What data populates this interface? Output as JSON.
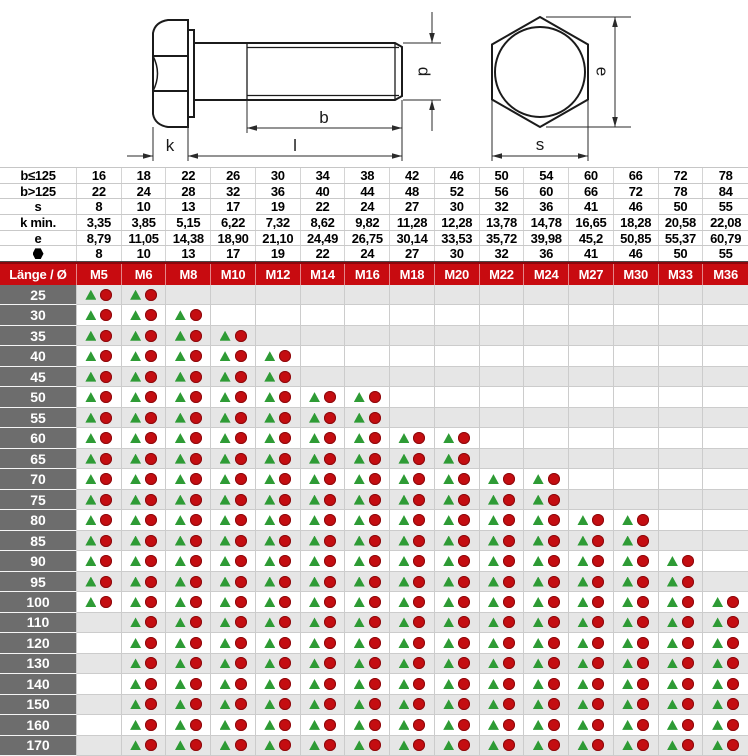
{
  "drawing": {
    "labels": {
      "k": "k",
      "l": "l",
      "b": "b",
      "d": "d",
      "e": "e",
      "s": "s"
    }
  },
  "spec_table": {
    "rows": [
      {
        "label": "b≤125",
        "values": [
          "16",
          "18",
          "22",
          "26",
          "30",
          "34",
          "38",
          "42",
          "46",
          "50",
          "54",
          "60",
          "66",
          "72",
          "78"
        ]
      },
      {
        "label": "b>125",
        "values": [
          "22",
          "24",
          "28",
          "32",
          "36",
          "40",
          "44",
          "48",
          "52",
          "56",
          "60",
          "66",
          "72",
          "78",
          "84"
        ]
      },
      {
        "label": "s",
        "values": [
          "8",
          "10",
          "13",
          "17",
          "19",
          "22",
          "24",
          "27",
          "30",
          "32",
          "36",
          "41",
          "46",
          "50",
          "55"
        ]
      },
      {
        "label": "k min.",
        "values": [
          "3,35",
          "3,85",
          "5,15",
          "6,22",
          "7,32",
          "8,62",
          "9,82",
          "11,28",
          "12,28",
          "13,78",
          "14,78",
          "16,65",
          "18,28",
          "20,58",
          "22,08"
        ]
      },
      {
        "label": "e",
        "values": [
          "8,79",
          "11,05",
          "14,38",
          "18,90",
          "21,10",
          "24,49",
          "26,75",
          "30,14",
          "33,53",
          "35,72",
          "39,98",
          "45,2",
          "50,85",
          "55,37",
          "60,79"
        ]
      },
      {
        "label": "●",
        "values": [
          "8",
          "10",
          "13",
          "17",
          "19",
          "22",
          "24",
          "27",
          "30",
          "32",
          "36",
          "41",
          "46",
          "50",
          "55"
        ]
      }
    ]
  },
  "matrix": {
    "corner_label": "Länge / Ø",
    "columns": [
      "M5",
      "M6",
      "M8",
      "M10",
      "M12",
      "M14",
      "M16",
      "M18",
      "M20",
      "M22",
      "M24",
      "M27",
      "M30",
      "M33",
      "M36"
    ],
    "symbols": {
      "triangle": "▲",
      "circle": "●"
    },
    "rows": [
      {
        "length": "25",
        "available": [
          1,
          1,
          0,
          0,
          0,
          0,
          0,
          0,
          0,
          0,
          0,
          0,
          0,
          0,
          0
        ]
      },
      {
        "length": "30",
        "available": [
          1,
          1,
          1,
          0,
          0,
          0,
          0,
          0,
          0,
          0,
          0,
          0,
          0,
          0,
          0
        ]
      },
      {
        "length": "35",
        "available": [
          1,
          1,
          1,
          1,
          0,
          0,
          0,
          0,
          0,
          0,
          0,
          0,
          0,
          0,
          0
        ]
      },
      {
        "length": "40",
        "available": [
          1,
          1,
          1,
          1,
          1,
          0,
          0,
          0,
          0,
          0,
          0,
          0,
          0,
          0,
          0
        ]
      },
      {
        "length": "45",
        "available": [
          1,
          1,
          1,
          1,
          1,
          0,
          0,
          0,
          0,
          0,
          0,
          0,
          0,
          0,
          0
        ]
      },
      {
        "length": "50",
        "available": [
          1,
          1,
          1,
          1,
          1,
          1,
          1,
          0,
          0,
          0,
          0,
          0,
          0,
          0,
          0
        ]
      },
      {
        "length": "55",
        "available": [
          1,
          1,
          1,
          1,
          1,
          1,
          1,
          0,
          0,
          0,
          0,
          0,
          0,
          0,
          0
        ]
      },
      {
        "length": "60",
        "available": [
          1,
          1,
          1,
          1,
          1,
          1,
          1,
          1,
          1,
          0,
          0,
          0,
          0,
          0,
          0
        ]
      },
      {
        "length": "65",
        "available": [
          1,
          1,
          1,
          1,
          1,
          1,
          1,
          1,
          1,
          0,
          0,
          0,
          0,
          0,
          0
        ]
      },
      {
        "length": "70",
        "available": [
          1,
          1,
          1,
          1,
          1,
          1,
          1,
          1,
          1,
          1,
          1,
          0,
          0,
          0,
          0
        ]
      },
      {
        "length": "75",
        "available": [
          1,
          1,
          1,
          1,
          1,
          1,
          1,
          1,
          1,
          1,
          1,
          0,
          0,
          0,
          0
        ]
      },
      {
        "length": "80",
        "available": [
          1,
          1,
          1,
          1,
          1,
          1,
          1,
          1,
          1,
          1,
          1,
          1,
          1,
          0,
          0
        ]
      },
      {
        "length": "85",
        "available": [
          1,
          1,
          1,
          1,
          1,
          1,
          1,
          1,
          1,
          1,
          1,
          1,
          1,
          0,
          0
        ]
      },
      {
        "length": "90",
        "available": [
          1,
          1,
          1,
          1,
          1,
          1,
          1,
          1,
          1,
          1,
          1,
          1,
          1,
          1,
          0
        ]
      },
      {
        "length": "95",
        "available": [
          1,
          1,
          1,
          1,
          1,
          1,
          1,
          1,
          1,
          1,
          1,
          1,
          1,
          1,
          0
        ]
      },
      {
        "length": "100",
        "available": [
          1,
          1,
          1,
          1,
          1,
          1,
          1,
          1,
          1,
          1,
          1,
          1,
          1,
          1,
          1
        ]
      },
      {
        "length": "110",
        "available": [
          0,
          1,
          1,
          1,
          1,
          1,
          1,
          1,
          1,
          1,
          1,
          1,
          1,
          1,
          1
        ]
      },
      {
        "length": "120",
        "available": [
          0,
          1,
          1,
          1,
          1,
          1,
          1,
          1,
          1,
          1,
          1,
          1,
          1,
          1,
          1
        ]
      },
      {
        "length": "130",
        "available": [
          0,
          1,
          1,
          1,
          1,
          1,
          1,
          1,
          1,
          1,
          1,
          1,
          1,
          1,
          1
        ]
      },
      {
        "length": "140",
        "available": [
          0,
          1,
          1,
          1,
          1,
          1,
          1,
          1,
          1,
          1,
          1,
          1,
          1,
          1,
          1
        ]
      },
      {
        "length": "150",
        "available": [
          0,
          1,
          1,
          1,
          1,
          1,
          1,
          1,
          1,
          1,
          1,
          1,
          1,
          1,
          1
        ]
      },
      {
        "length": "160",
        "available": [
          0,
          1,
          1,
          1,
          1,
          1,
          1,
          1,
          1,
          1,
          1,
          1,
          1,
          1,
          1
        ]
      },
      {
        "length": "170",
        "available": [
          0,
          1,
          1,
          1,
          1,
          1,
          1,
          1,
          1,
          1,
          1,
          1,
          1,
          1,
          1
        ]
      }
    ]
  },
  "colors": {
    "header_red": "#c80b10",
    "triangle_green": "#2e9b35",
    "circle_red": "#c40d11",
    "row_gray": "#e6e6e6",
    "label_gray": "#6d6d6d"
  }
}
